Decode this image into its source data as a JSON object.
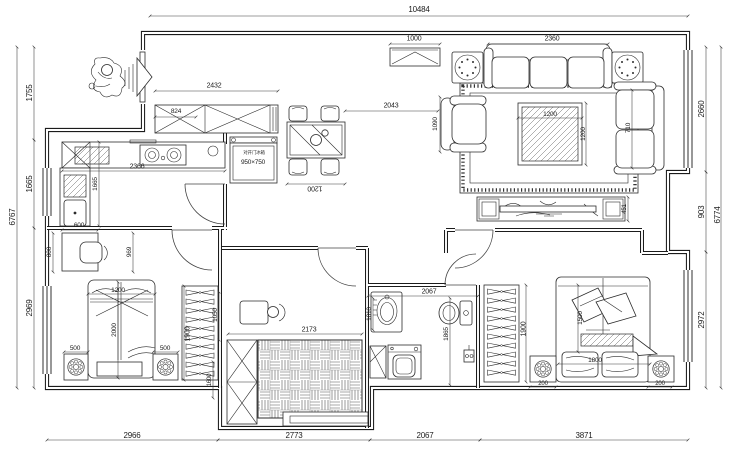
{
  "drawing": {
    "kind": "apartment floor plan",
    "line_color": "#1b1b1b",
    "bg_color": "#ffffff"
  },
  "dims": {
    "overall_width": "10484",
    "left_1755": "1755",
    "left_1665": "1665",
    "left_2969": "2969",
    "left_overall": "6767",
    "right_2660": "2660",
    "right_903": "903",
    "right_2972": "2972",
    "right_overall": "6774",
    "bottom_2966": "2966",
    "bottom_2773": "2773",
    "bottom_2067": "2067",
    "bottom_3871": "3871",
    "entry_cabinet": "1000",
    "sofa_width": "2360",
    "hall_cabinet": "2432",
    "hall_cabinet_sub": "824",
    "hallway_length": "2043",
    "armchair_width": "1090",
    "counter_length": "2366",
    "kitchen_depth": "1665",
    "fridge_label": "对开门冰箱",
    "fridge_size": "950×750",
    "dining_width": "1200",
    "coffee_table_w": "1200",
    "coffee_table_d": "1200",
    "loveseat_width": "710",
    "tv_cabinet_depth": "451",
    "desk_width": "600",
    "desk_depth": "800",
    "desk_offset": "969",
    "bed2_width": "1200",
    "bed2_length": "2000",
    "bed2_ns_left": "500",
    "bed2_ns_right": "500",
    "wardrobe2_length": "1900",
    "closet_gap": "1050",
    "wardrobe_width": "1600",
    "tatami_width": "2173",
    "bath_width": "2067",
    "sink_offset": "1810",
    "bath_depth": "1865",
    "wardrobe1_length": "1900",
    "bed1_width": "1500",
    "bed1_inner": "1800",
    "bed1_ns_left": "200",
    "bed1_ns_right": "200"
  }
}
